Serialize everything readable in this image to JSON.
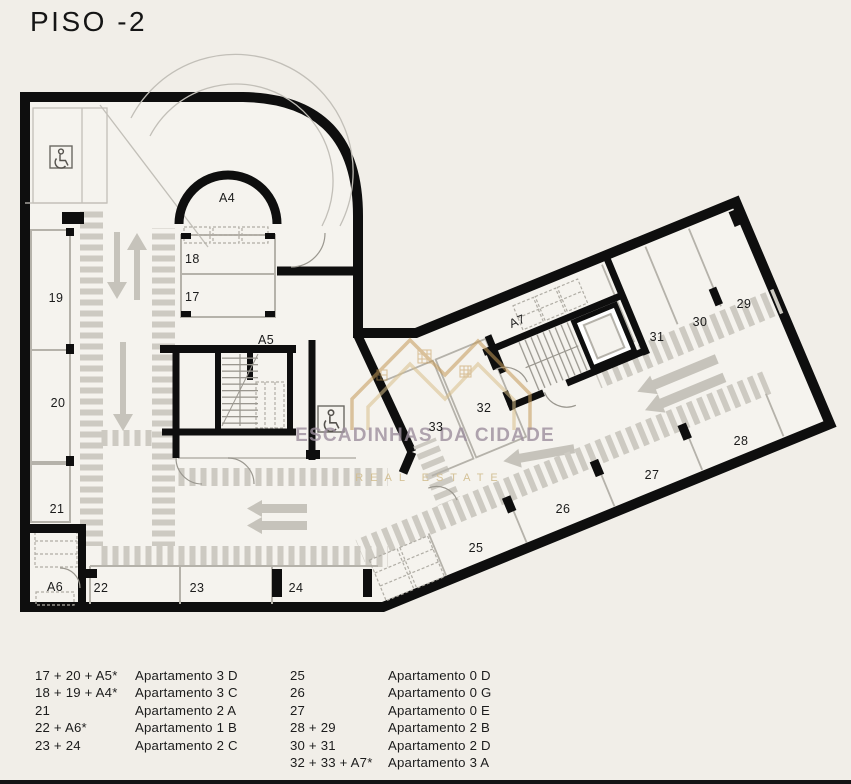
{
  "title": "PISO -2",
  "watermark": {
    "name": "ESCADINHAS DA CIDADE",
    "tagline": "REAL ESTATE"
  },
  "plan": {
    "labels": {
      "s17": "17",
      "s18": "18",
      "s19": "19",
      "s20": "20",
      "s21": "21",
      "s22": "22",
      "s23": "23",
      "s24": "24",
      "s25": "25",
      "s26": "26",
      "s27": "27",
      "s28": "28",
      "s29": "29",
      "s30": "30",
      "s31": "31",
      "s32": "32",
      "s33": "33",
      "a4": "A4",
      "a5": "A5",
      "a6": "A6",
      "a7": "A7"
    }
  },
  "legend": {
    "col1": [
      {
        "spots": "17 + 20 + A5*",
        "apartment": "Apartamento 3 D"
      },
      {
        "spots": "18 + 19 + A4*",
        "apartment": "Apartamento 3 C"
      },
      {
        "spots": "21",
        "apartment": "Apartamento 2 A"
      },
      {
        "spots": "22 + A6*",
        "apartment": "Apartamento 1 B"
      },
      {
        "spots": "23 + 24",
        "apartment": "Apartamento 2 C"
      }
    ],
    "col2": [
      {
        "spots": "25",
        "apartment": "Apartamento 0 D"
      },
      {
        "spots": "26",
        "apartment": "Apartamento 0 G"
      },
      {
        "spots": "27",
        "apartment": "Apartamento 0 E"
      },
      {
        "spots": "28 + 29",
        "apartment": "Apartamento 2 B"
      },
      {
        "spots": "30 + 31",
        "apartment": "Apartamento 2 D"
      },
      {
        "spots": "32 + 33 + A7*",
        "apartment": "Apartamento 3 A"
      }
    ]
  },
  "colors": {
    "background": "#f1eee8",
    "floor": "#f5f3ee",
    "wall": "#0e0e0e",
    "hatch": "#cdcac2",
    "thin_wall": "#b5b2aa",
    "watermark_text": "#9d8f9e",
    "watermark_tagline": "#d3bf92",
    "logo_gold": "#c49a58"
  }
}
